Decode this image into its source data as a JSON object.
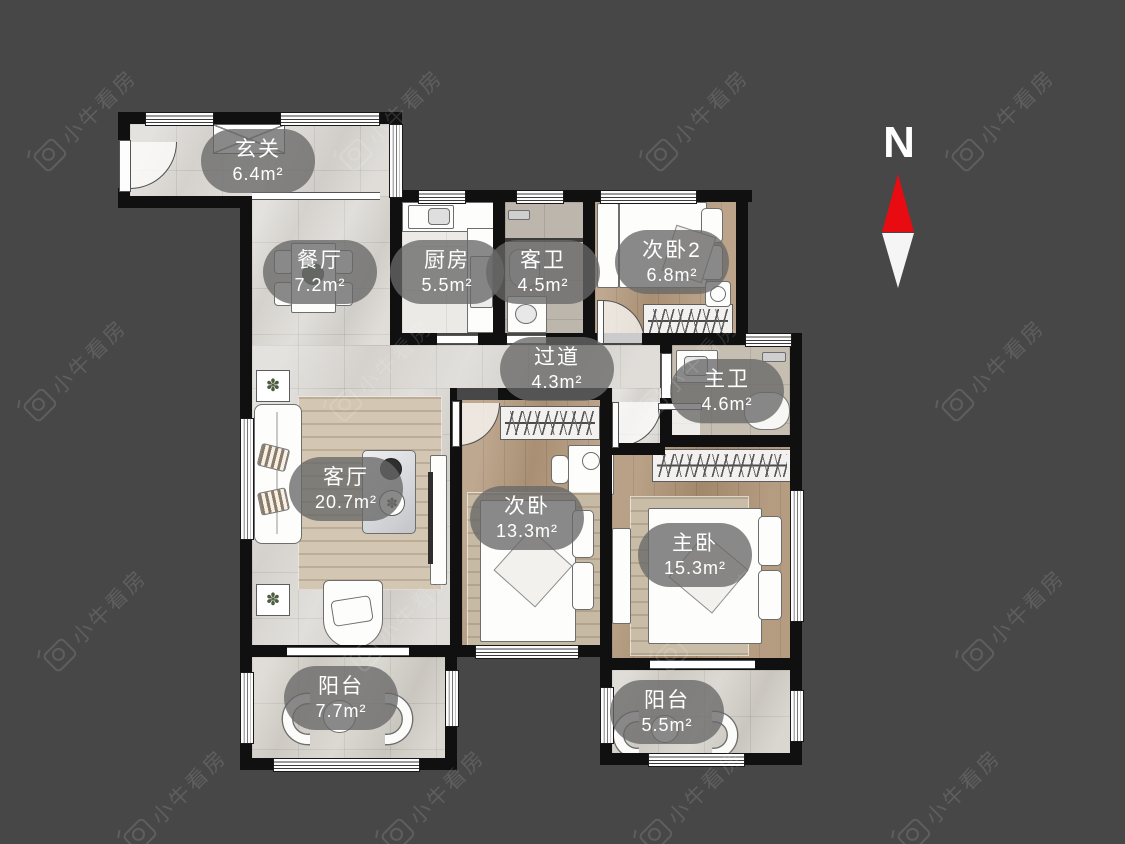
{
  "meta": {
    "app": "floor-plan-viewer",
    "background_color": "#474747",
    "wall_color": "#101010",
    "accent_red": "#e80b12",
    "badge_color": "rgba(104,104,104,0.78)"
  },
  "watermark": {
    "text": "小牛看房",
    "logo": "bull-camera-icon"
  },
  "compass": {
    "label": "N",
    "arrow": "red-white-north-needle"
  },
  "rooms": [
    {
      "name": "玄关",
      "area": "6.4m²"
    },
    {
      "name": "餐厅",
      "area": "7.2m²"
    },
    {
      "name": "厨房",
      "area": "5.5m²"
    },
    {
      "name": "客卫",
      "area": "4.5m²"
    },
    {
      "name": "次卧2",
      "area": "6.8m²"
    },
    {
      "name": "过道",
      "area": "4.3m²"
    },
    {
      "name": "主卫",
      "area": "4.6m²"
    },
    {
      "name": "客厅",
      "area": "20.7m²"
    },
    {
      "name": "次卧",
      "area": "13.3m²"
    },
    {
      "name": "主卧",
      "area": "15.3m²"
    },
    {
      "name": "阳台",
      "area": "7.7m²"
    },
    {
      "name": "阳台",
      "area": "5.5m²"
    }
  ]
}
